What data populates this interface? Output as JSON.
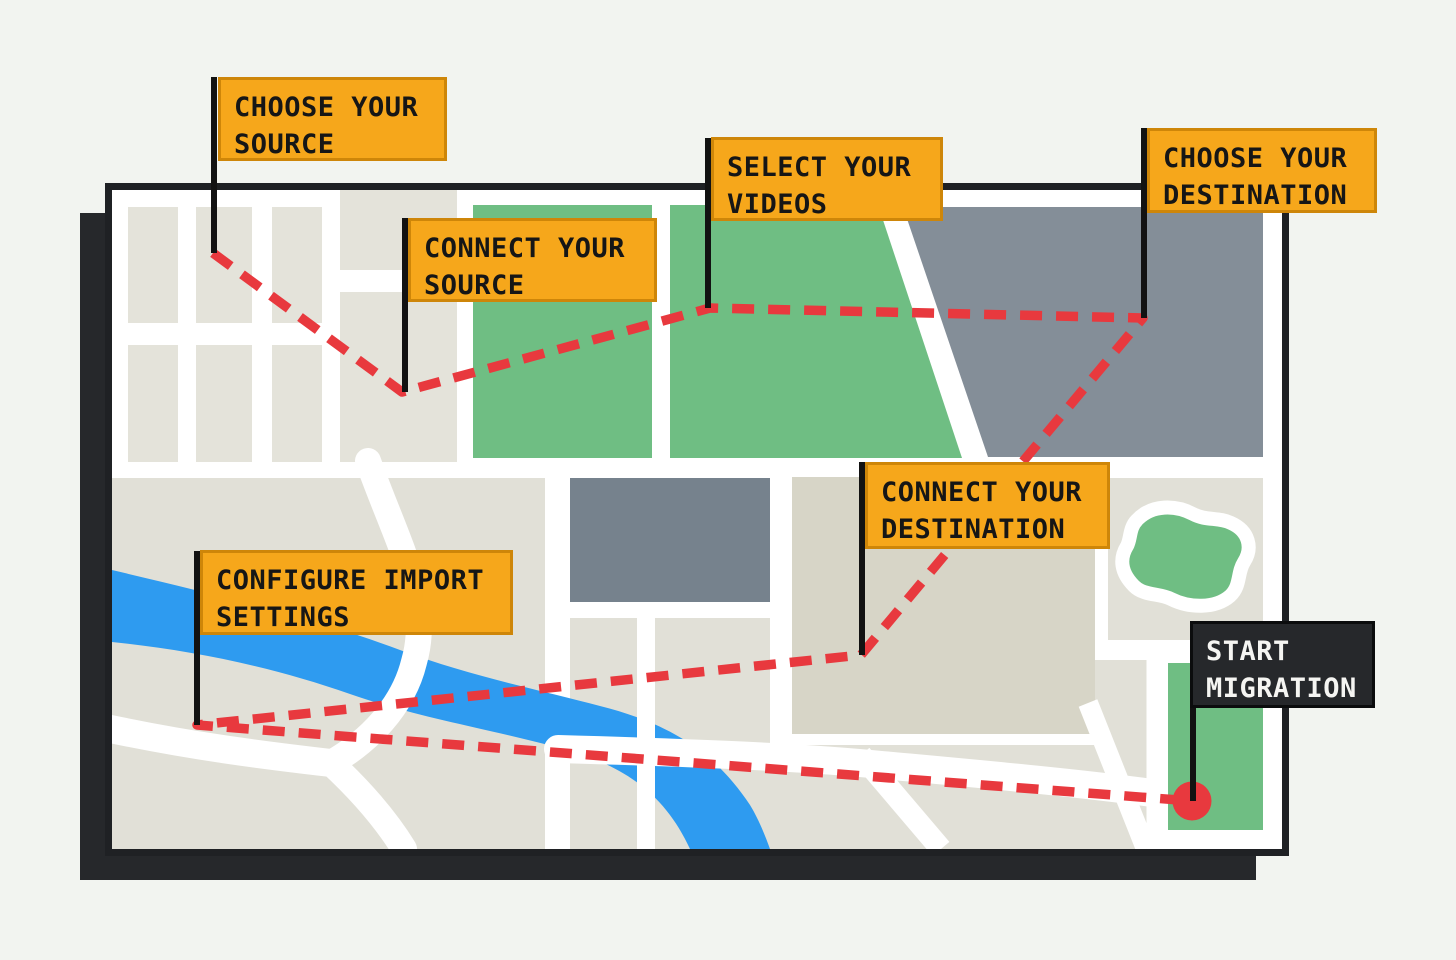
{
  "illustration": "stylized street map with step flags for a video migration journey",
  "colors": {
    "page_background": "#F2F4F0",
    "map_canvas": "#FFFFFF",
    "map_border": "#1F2124",
    "map_shadow": "#26282B",
    "city_block": "#E4E3DA",
    "land": "#E1E0D7",
    "land_dark": "#D7D5C7",
    "park_green": "#6FBE83",
    "building_slate": "#848E98",
    "building_slate_mid": "#76828D",
    "river_blue": "#2E9BF0",
    "route_red": "#E8393E",
    "flag_orange": "#F6A71B",
    "flag_orange_border": "#CE8609",
    "flag_dark": "#26282B",
    "flag_text": "#161616",
    "flag_dark_text": "#F5F5F2",
    "pole_black": "#121212"
  },
  "steps": [
    {
      "id": "choose-source",
      "line1": "CHOOSE YOUR",
      "line2": "SOURCE",
      "style": "orange"
    },
    {
      "id": "connect-source",
      "line1": "CONNECT YOUR",
      "line2": "SOURCE",
      "style": "orange"
    },
    {
      "id": "select-videos",
      "line1": "SELECT YOUR",
      "line2": "VIDEOS",
      "style": "orange"
    },
    {
      "id": "choose-destination",
      "line1": "CHOOSE YOUR",
      "line2": "DESTINATION",
      "style": "orange"
    },
    {
      "id": "connect-destination",
      "line1": "CONNECT YOUR",
      "line2": "DESTINATION",
      "style": "orange"
    },
    {
      "id": "configure-import",
      "line1": "CONFIGURE IMPORT",
      "line2": "SETTINGS",
      "style": "orange"
    },
    {
      "id": "start-migration",
      "line1": "START",
      "line2": "MIGRATION",
      "style": "dark"
    }
  ],
  "route": {
    "style": "dashed",
    "color": "#E8393E",
    "end_marker": "red-dot"
  }
}
